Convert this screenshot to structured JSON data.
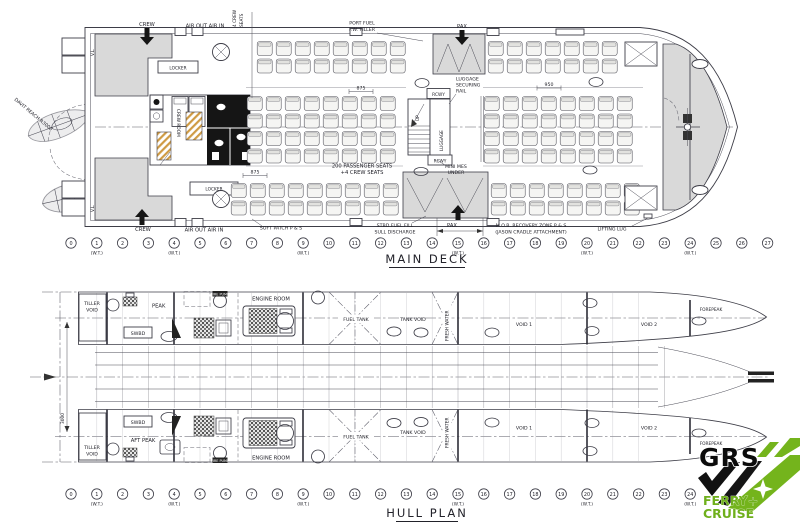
{
  "colors": {
    "line": "#3d3d47",
    "shade": "#d9d9d9",
    "hatch_tan": "#cf9b45",
    "logo_green": "#74b41c",
    "logo_black": "#111111"
  },
  "main_deck": {
    "title": "MAIN DECK",
    "frame_row": {
      "start": 0,
      "end": 27,
      "wt": [
        1,
        4,
        9,
        15,
        20,
        24
      ],
      "wt_label": "(W.T.)"
    },
    "top": {
      "crew": "CREW",
      "air": "AIR OUT AIR IN",
      "crew_seats_1": "4 CREW",
      "crew_seats_2": "SEATS",
      "port_fuel_1": "PORT FUEL",
      "port_fuel_2": "F.W. FILLER",
      "pax": "PAX"
    },
    "bottom": {
      "crew": "CREW",
      "air": "AIR OUT AIR IN",
      "soft_patch": "SOFT PATCH P & S",
      "stbd_fuel_1": "STBD FUEL FILL",
      "stbd_fuel_2": "SULL DISCHARGE",
      "pax": "PAX",
      "mob_1": "M.O.B. RECOVERY ZONE P & S",
      "mob_2": "(JASON CRADLE ATTACHMENT)",
      "lifting_lug": "LIFTING LUG"
    },
    "interior": {
      "locker_top": "LOCKER",
      "locker_bottom": "LOCKER",
      "crew_room": "CREW ROOM",
      "rcwy_top": "RCWY",
      "rcwy_bottom": "RCWY",
      "up": "UP",
      "luggage": "LUGGAGE",
      "rail_1": "LUGGAGE",
      "rail_2": "SECURING",
      "rail_3": "RAIL",
      "mini_mes_1": "MINI MES",
      "mini_mes_2": "UNDER",
      "seats_note_1": "200 PASSENGER SEATS",
      "seats_note_2": "+4 CREW SEATS"
    },
    "dims": {
      "mid_875": "875",
      "aft_875": "875",
      "fwd_950": "950"
    },
    "port_equipment": {
      "davit": "DAVIT REACH R3000",
      "vl_fwd": "V.L.",
      "vl_aft": "V.L."
    }
  },
  "hull_plan": {
    "title": "HULL PLAN",
    "frame_row": {
      "start": 0,
      "end": 24,
      "wt": [
        1,
        4,
        9,
        15,
        20,
        24
      ],
      "wt_label": "(W.T.)"
    },
    "port_hull": {
      "tiller_1": "TILLER",
      "tiller_2": "VOID",
      "peak": "PEAK",
      "swbd": "SWBD",
      "fire_pump": "FIRE PUMP",
      "engine_room": "ENGINE ROOM",
      "fuel_tank": "FUEL TANK",
      "tank_void": "TANK VOID",
      "fresh_water": "FRESH WATER",
      "void_1": "VOID 1",
      "void_2": "VOID 2",
      "forepeak": "FOREPEAK"
    },
    "stbd_hull": {
      "tiller_1": "TILLER",
      "tiller_2": "VOID",
      "aft_peak": "AFT PEAK",
      "swbd": "SWBD",
      "fire_pump": "FIRE PUMP",
      "engine_room": "ENGINE ROOM",
      "fuel_tank": "FUEL TANK",
      "tank_void": "TANK VOID",
      "fresh_water": "FRESH WATER",
      "void_1": "VOID 1",
      "void_2": "VOID 2",
      "forepeak": "FOREPEAK"
    },
    "dim_3000": "3000"
  },
  "logo": {
    "brand": "GRS",
    "tagline_1": "FERRY+",
    "tagline_2": "CRUISE"
  }
}
